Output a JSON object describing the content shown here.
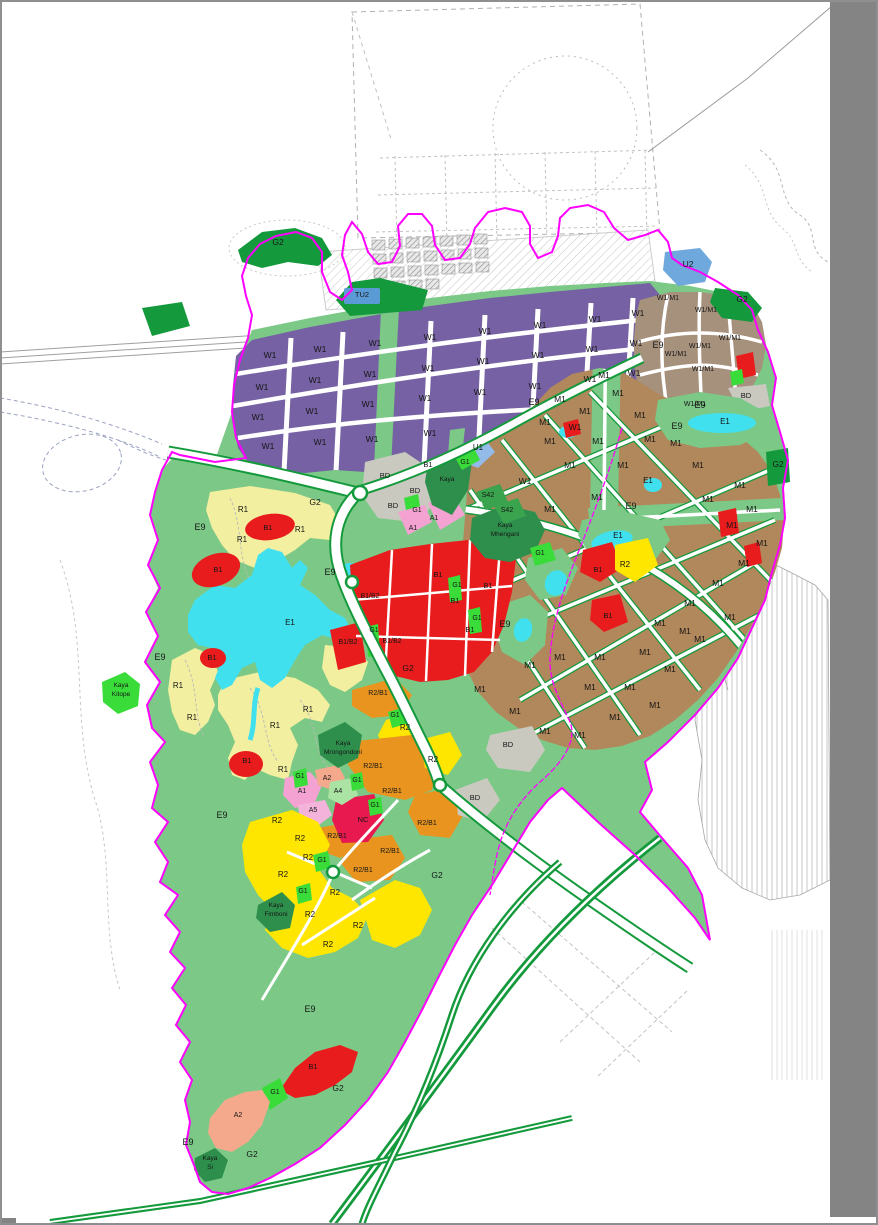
{
  "canvas": {
    "width": 878,
    "height": 1225,
    "paper_color": "#ffffff",
    "frame_color": "#8f8f8f",
    "margin_color": "#848484"
  },
  "palette": {
    "W1": "#7561A3",
    "M1": "#B1885C",
    "W1M1": "#A6917C",
    "R1": "#F3EFA0",
    "R2": "#FFE600",
    "R2B1": "#E8941F",
    "B1": "#E81C1C",
    "B1B2": "#E81C1C",
    "NC": "#E7194E",
    "A1": "#F3A2D2",
    "A2": "#F5A98C",
    "A4": "#AAE3A4",
    "A5": "#F4B3DA",
    "BD": "#C9C9C0",
    "E1": "#41E0EF",
    "E9": "#7CC987",
    "G1": "#3ADC3A",
    "G2": "#149A3C",
    "KAYA": "#2E8F4C",
    "U1": "#93BBE8",
    "U2": "#6FA8DC",
    "TU2": "#5B9BD5",
    "S42": "#3AA34E",
    "ROAD": "#FFFFFF",
    "BOUNDARY": "#FF00FF"
  },
  "map": {
    "place_names": [
      "Kaya Mhengani",
      "Kaya Mrongondoni",
      "Kaya Fimboni",
      "Kaya Kitope",
      "Kaya Si"
    ],
    "labels": [
      {
        "t": "W1",
        "x": 270,
        "y": 358
      },
      {
        "t": "W1",
        "x": 320,
        "y": 352
      },
      {
        "t": "W1",
        "x": 375,
        "y": 346
      },
      {
        "t": "W1",
        "x": 430,
        "y": 340
      },
      {
        "t": "W1",
        "x": 485,
        "y": 334
      },
      {
        "t": "W1",
        "x": 540,
        "y": 328
      },
      {
        "t": "W1",
        "x": 595,
        "y": 322
      },
      {
        "t": "W1",
        "x": 638,
        "y": 316
      },
      {
        "t": "W1",
        "x": 262,
        "y": 390
      },
      {
        "t": "W1",
        "x": 315,
        "y": 383
      },
      {
        "t": "W1",
        "x": 370,
        "y": 377
      },
      {
        "t": "W1",
        "x": 428,
        "y": 371
      },
      {
        "t": "W1",
        "x": 483,
        "y": 364
      },
      {
        "t": "W1",
        "x": 538,
        "y": 358
      },
      {
        "t": "W1",
        "x": 592,
        "y": 352
      },
      {
        "t": "W1",
        "x": 636,
        "y": 346
      },
      {
        "t": "W1",
        "x": 258,
        "y": 420
      },
      {
        "t": "W1",
        "x": 312,
        "y": 414
      },
      {
        "t": "W1",
        "x": 368,
        "y": 407
      },
      {
        "t": "W1",
        "x": 425,
        "y": 401
      },
      {
        "t": "W1",
        "x": 480,
        "y": 395
      },
      {
        "t": "W1",
        "x": 535,
        "y": 389
      },
      {
        "t": "W1",
        "x": 590,
        "y": 382
      },
      {
        "t": "W1",
        "x": 634,
        "y": 376
      },
      {
        "t": "W1",
        "x": 268,
        "y": 449
      },
      {
        "t": "W1",
        "x": 320,
        "y": 445
      },
      {
        "t": "W1",
        "x": 372,
        "y": 442
      },
      {
        "t": "W1",
        "x": 430,
        "y": 436
      },
      {
        "t": "W1",
        "x": 525,
        "y": 484
      },
      {
        "t": "W1",
        "x": 575,
        "y": 430
      },
      {
        "t": "M1",
        "x": 545,
        "y": 425
      },
      {
        "t": "M1",
        "x": 585,
        "y": 414
      },
      {
        "t": "M1",
        "x": 604,
        "y": 378
      },
      {
        "t": "M1",
        "x": 560,
        "y": 402
      },
      {
        "t": "M1",
        "x": 618,
        "y": 396
      },
      {
        "t": "M1",
        "x": 640,
        "y": 418
      },
      {
        "t": "M1",
        "x": 550,
        "y": 444
      },
      {
        "t": "M1",
        "x": 598,
        "y": 444
      },
      {
        "t": "M1",
        "x": 650,
        "y": 442
      },
      {
        "t": "M1",
        "x": 570,
        "y": 468
      },
      {
        "t": "M1",
        "x": 623,
        "y": 468
      },
      {
        "t": "M1",
        "x": 676,
        "y": 446
      },
      {
        "t": "M1",
        "x": 698,
        "y": 468
      },
      {
        "t": "M1",
        "x": 740,
        "y": 488
      },
      {
        "t": "M1",
        "x": 708,
        "y": 502
      },
      {
        "t": "M1",
        "x": 752,
        "y": 512
      },
      {
        "t": "M1",
        "x": 732,
        "y": 528
      },
      {
        "t": "M1",
        "x": 762,
        "y": 546
      },
      {
        "t": "M1",
        "x": 744,
        "y": 566
      },
      {
        "t": "M1",
        "x": 718,
        "y": 586
      },
      {
        "t": "M1",
        "x": 690,
        "y": 606
      },
      {
        "t": "M1",
        "x": 660,
        "y": 626
      },
      {
        "t": "M1",
        "x": 700,
        "y": 642
      },
      {
        "t": "M1",
        "x": 730,
        "y": 620
      },
      {
        "t": "M1",
        "x": 597,
        "y": 500
      },
      {
        "t": "M1",
        "x": 550,
        "y": 512
      },
      {
        "t": "M1",
        "x": 560,
        "y": 660
      },
      {
        "t": "M1",
        "x": 600,
        "y": 660
      },
      {
        "t": "M1",
        "x": 645,
        "y": 655
      },
      {
        "t": "M1",
        "x": 685,
        "y": 634
      },
      {
        "t": "M1",
        "x": 590,
        "y": 690
      },
      {
        "t": "M1",
        "x": 630,
        "y": 690
      },
      {
        "t": "M1",
        "x": 670,
        "y": 672
      },
      {
        "t": "M1",
        "x": 480,
        "y": 692
      },
      {
        "t": "M1",
        "x": 515,
        "y": 714
      },
      {
        "t": "M1",
        "x": 545,
        "y": 734
      },
      {
        "t": "M1",
        "x": 580,
        "y": 738
      },
      {
        "t": "M1",
        "x": 615,
        "y": 720
      },
      {
        "t": "M1",
        "x": 655,
        "y": 708
      },
      {
        "t": "M1",
        "x": 530,
        "y": 668
      },
      {
        "t": "W1/M1",
        "x": 668,
        "y": 300,
        "s": 7
      },
      {
        "t": "W1/M1",
        "x": 706,
        "y": 312,
        "s": 7
      },
      {
        "t": "W1/M1",
        "x": 730,
        "y": 340,
        "s": 7
      },
      {
        "t": "W1/M1",
        "x": 700,
        "y": 348,
        "s": 7
      },
      {
        "t": "W1/M1",
        "x": 676,
        "y": 356,
        "s": 7
      },
      {
        "t": "W1/M1",
        "x": 703,
        "y": 371,
        "s": 7
      },
      {
        "t": "W1/M1",
        "x": 695,
        "y": 406,
        "s": 7
      },
      {
        "t": "R1",
        "x": 243,
        "y": 512,
        "s": 8
      },
      {
        "t": "R1",
        "x": 242,
        "y": 542,
        "s": 8
      },
      {
        "t": "R1",
        "x": 300,
        "y": 532,
        "s": 8
      },
      {
        "t": "R1",
        "x": 178,
        "y": 688,
        "s": 8
      },
      {
        "t": "R1",
        "x": 192,
        "y": 720,
        "s": 8
      },
      {
        "t": "R1",
        "x": 308,
        "y": 712,
        "s": 8
      },
      {
        "t": "R1",
        "x": 275,
        "y": 728,
        "s": 8
      },
      {
        "t": "R1",
        "x": 283,
        "y": 772,
        "s": 8
      },
      {
        "t": "R2",
        "x": 405,
        "y": 730,
        "s": 8
      },
      {
        "t": "R2",
        "x": 433,
        "y": 762,
        "s": 8
      },
      {
        "t": "R2",
        "x": 625,
        "y": 567,
        "s": 8
      },
      {
        "t": "R2",
        "x": 277,
        "y": 823,
        "s": 8
      },
      {
        "t": "R2",
        "x": 308,
        "y": 860,
        "s": 8
      },
      {
        "t": "R2",
        "x": 283,
        "y": 877,
        "s": 8
      },
      {
        "t": "R2",
        "x": 335,
        "y": 895,
        "s": 8
      },
      {
        "t": "R2",
        "x": 310,
        "y": 917,
        "s": 8
      },
      {
        "t": "R2",
        "x": 358,
        "y": 928,
        "s": 8
      },
      {
        "t": "R2",
        "x": 328,
        "y": 947,
        "s": 8
      },
      {
        "t": "R2",
        "x": 300,
        "y": 841,
        "s": 8
      },
      {
        "t": "R2/B1",
        "x": 378,
        "y": 695,
        "s": 7
      },
      {
        "t": "R2/B1",
        "x": 373,
        "y": 768,
        "s": 7
      },
      {
        "t": "R2/B1",
        "x": 392,
        "y": 793,
        "s": 7
      },
      {
        "t": "R2/B1",
        "x": 427,
        "y": 825,
        "s": 7
      },
      {
        "t": "R2/B1",
        "x": 337,
        "y": 838,
        "s": 7
      },
      {
        "t": "R2/B1",
        "x": 390,
        "y": 853,
        "s": 7
      },
      {
        "t": "R2/B1",
        "x": 363,
        "y": 872,
        "s": 7
      },
      {
        "t": "B1",
        "x": 268,
        "y": 530,
        "s": 7.5
      },
      {
        "t": "B1",
        "x": 218,
        "y": 572,
        "s": 7.5
      },
      {
        "t": "B1",
        "x": 212,
        "y": 660,
        "s": 7.5
      },
      {
        "t": "B1",
        "x": 247,
        "y": 763,
        "s": 7.5
      },
      {
        "t": "B1",
        "x": 438,
        "y": 577,
        "s": 7.5
      },
      {
        "t": "B1",
        "x": 455,
        "y": 603,
        "s": 7.5
      },
      {
        "t": "B1",
        "x": 488,
        "y": 588,
        "s": 7.5
      },
      {
        "t": "B1",
        "x": 470,
        "y": 632,
        "s": 7.5
      },
      {
        "t": "B1",
        "x": 598,
        "y": 572,
        "s": 7.5
      },
      {
        "t": "B1",
        "x": 608,
        "y": 618,
        "s": 7.5
      },
      {
        "t": "B1",
        "x": 313,
        "y": 1069,
        "s": 7.5
      },
      {
        "t": "B1",
        "x": 428,
        "y": 467,
        "s": 7.5
      },
      {
        "t": "B1/B2",
        "x": 370,
        "y": 598,
        "s": 7
      },
      {
        "t": "B1/B2",
        "x": 348,
        "y": 644,
        "s": 7
      },
      {
        "t": "B1/B2",
        "x": 392,
        "y": 643,
        "s": 7
      },
      {
        "t": "NC",
        "x": 363,
        "y": 822,
        "s": 7.5
      },
      {
        "t": "A1",
        "x": 434,
        "y": 520,
        "s": 7
      },
      {
        "t": "A1",
        "x": 413,
        "y": 530,
        "s": 7
      },
      {
        "t": "A1",
        "x": 302,
        "y": 793,
        "s": 7
      },
      {
        "t": "A2",
        "x": 327,
        "y": 780,
        "s": 7
      },
      {
        "t": "A2",
        "x": 238,
        "y": 1117,
        "s": 7
      },
      {
        "t": "A4",
        "x": 338,
        "y": 793,
        "s": 7
      },
      {
        "t": "A5",
        "x": 313,
        "y": 812,
        "s": 7
      },
      {
        "t": "BD",
        "x": 385,
        "y": 478,
        "s": 7.5
      },
      {
        "t": "BD",
        "x": 415,
        "y": 493,
        "s": 7.5
      },
      {
        "t": "BD",
        "x": 393,
        "y": 508,
        "s": 7.5
      },
      {
        "t": "BD",
        "x": 746,
        "y": 398,
        "s": 7.5
      },
      {
        "t": "BD",
        "x": 508,
        "y": 747,
        "s": 7.5
      },
      {
        "t": "BD",
        "x": 475,
        "y": 800,
        "s": 7.5
      },
      {
        "t": "G1",
        "x": 465,
        "y": 464,
        "s": 7
      },
      {
        "t": "G1",
        "x": 417,
        "y": 512,
        "s": 7
      },
      {
        "t": "G1",
        "x": 540,
        "y": 555,
        "s": 7
      },
      {
        "t": "G1",
        "x": 457,
        "y": 587,
        "s": 7
      },
      {
        "t": "G1",
        "x": 477,
        "y": 620,
        "s": 7
      },
      {
        "t": "G1",
        "x": 374,
        "y": 632,
        "s": 7
      },
      {
        "t": "G1",
        "x": 395,
        "y": 717,
        "s": 7
      },
      {
        "t": "G1",
        "x": 300,
        "y": 778,
        "s": 7
      },
      {
        "t": "G1",
        "x": 357,
        "y": 782,
        "s": 7
      },
      {
        "t": "G1",
        "x": 375,
        "y": 807,
        "s": 7
      },
      {
        "t": "G1",
        "x": 322,
        "y": 862,
        "s": 7
      },
      {
        "t": "G1",
        "x": 303,
        "y": 893,
        "s": 7
      },
      {
        "t": "G1",
        "x": 275,
        "y": 1094,
        "s": 7
      },
      {
        "t": "G2",
        "x": 278,
        "y": 245
      },
      {
        "t": "G2",
        "x": 742,
        "y": 302
      },
      {
        "t": "G2",
        "x": 778,
        "y": 467
      },
      {
        "t": "G2",
        "x": 315,
        "y": 505
      },
      {
        "t": "G2",
        "x": 408,
        "y": 671
      },
      {
        "t": "G2",
        "x": 437,
        "y": 878
      },
      {
        "t": "G2",
        "x": 338,
        "y": 1091
      },
      {
        "t": "G2",
        "x": 252,
        "y": 1157
      },
      {
        "t": "E9",
        "x": 200,
        "y": 530,
        "s": 9
      },
      {
        "t": "E9",
        "x": 330,
        "y": 575,
        "s": 9
      },
      {
        "t": "E9",
        "x": 160,
        "y": 660,
        "s": 9
      },
      {
        "t": "E9",
        "x": 222,
        "y": 818,
        "s": 9
      },
      {
        "t": "E9",
        "x": 310,
        "y": 1012,
        "s": 9
      },
      {
        "t": "E9",
        "x": 188,
        "y": 1145,
        "s": 9
      },
      {
        "t": "E9",
        "x": 658,
        "y": 348,
        "s": 9
      },
      {
        "t": "E9",
        "x": 534,
        "y": 405,
        "s": 9
      },
      {
        "t": "E9",
        "x": 677,
        "y": 429,
        "s": 9
      },
      {
        "t": "E9",
        "x": 631,
        "y": 509,
        "s": 9
      },
      {
        "t": "E9",
        "x": 505,
        "y": 627,
        "s": 9
      },
      {
        "t": "E9",
        "x": 700,
        "y": 408,
        "s": 9
      },
      {
        "t": "E1",
        "x": 290,
        "y": 625,
        "s": 8
      },
      {
        "t": "E1",
        "x": 648,
        "y": 483,
        "s": 8
      },
      {
        "t": "E1",
        "x": 725,
        "y": 424,
        "s": 8
      },
      {
        "t": "E1",
        "x": 618,
        "y": 538,
        "s": 8
      },
      {
        "t": "U1",
        "x": 478,
        "y": 450,
        "s": 8
      },
      {
        "t": "U2",
        "x": 688,
        "y": 267
      },
      {
        "t": "TU2",
        "x": 362,
        "y": 297,
        "s": 7.5
      },
      {
        "t": "S42",
        "x": 488,
        "y": 497,
        "s": 7
      },
      {
        "t": "S42",
        "x": 507,
        "y": 512,
        "s": 7
      },
      {
        "t": "Kaya",
        "x": 447,
        "y": 481,
        "s": 6.5
      },
      {
        "t": "Kaya",
        "x": 505,
        "y": 527,
        "s": 6.5
      },
      {
        "t": "Mhengani",
        "x": 505,
        "y": 536,
        "s": 6.5
      },
      {
        "t": "Kaya",
        "x": 343,
        "y": 745,
        "s": 6.5
      },
      {
        "t": "Mrongondoni",
        "x": 343,
        "y": 754,
        "s": 6.5
      },
      {
        "t": "Kaya",
        "x": 276,
        "y": 907,
        "s": 6.5
      },
      {
        "t": "Fimboni",
        "x": 276,
        "y": 916,
        "s": 6.5
      },
      {
        "t": "Kaya",
        "x": 121,
        "y": 687,
        "s": 6.5
      },
      {
        "t": "Kitope",
        "x": 121,
        "y": 696,
        "s": 6.5
      },
      {
        "t": "Kaya",
        "x": 210,
        "y": 1160,
        "s": 6.5
      },
      {
        "t": "Si",
        "x": 210,
        "y": 1169,
        "s": 6.5
      }
    ]
  }
}
